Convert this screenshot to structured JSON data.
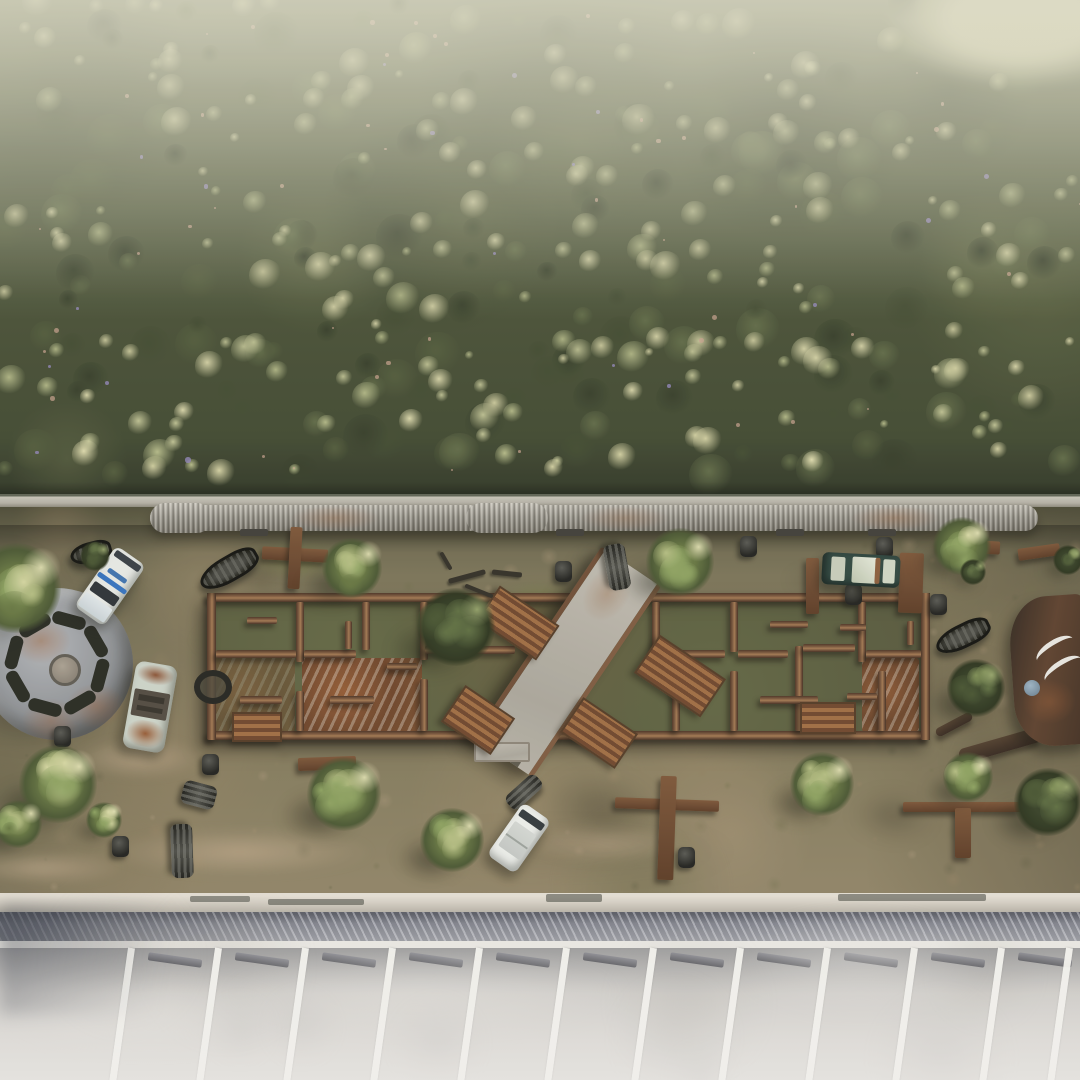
{
  "scene": {
    "type": "aerial-3d-render",
    "description": "Top-down aerial render: dense forest strip, corrugated pipe barrier, dirt paintball arena with ruined roofless building crossed by a diagonal concrete ramp, scrap props (cars, inflatable boats, barrels, wooden crosses, turbine disc, wrecked fuselage), and an angled parking lot at bottom",
    "palette": {
      "forest_pale": [
        "#e0dcab",
        "#d2cf9e",
        "#c2c492",
        "#b5ba85"
      ],
      "forest_dark": [
        "#4e5736",
        "#3e472c",
        "#5d6742",
        "#323a24"
      ],
      "flower_purple": "#8d82b8",
      "speck_pink": "#c9a08a",
      "dirt_tones": [
        "#8d7c5a",
        "#a18a66",
        "#6d6a46",
        "#5c5a3e",
        "#b09a79",
        "#97805f",
        "#7a7050"
      ],
      "haze": "#e3e1c9",
      "rust": "#8a5a36",
      "concrete": "#b5b0a4",
      "moss": "#6a7042"
    },
    "forest": {
      "height": 497,
      "pond": {
        "x": 1020,
        "y": 22,
        "rx": 130,
        "ry": 62,
        "color": "#c9c7a2"
      }
    },
    "pipe": {
      "x": 150,
      "y": 505,
      "w": 888,
      "sleeves": [
        [
          0,
          62
        ],
        [
          316,
          82
        ]
      ],
      "feet": [
        90,
        406,
        626,
        718
      ]
    },
    "building": {
      "x": 207,
      "y": 593,
      "w": 723,
      "h": 147,
      "wall": 9,
      "v_walls": [
        [
          89,
          9,
          60
        ],
        [
          89,
          98,
          40
        ],
        [
          155,
          9,
          48
        ],
        [
          213,
          9,
          58
        ],
        [
          213,
          86,
          52
        ],
        [
          338,
          62,
          76
        ],
        [
          445,
          9,
          53
        ],
        [
          465,
          62,
          76
        ],
        [
          523,
          9,
          50
        ],
        [
          523,
          78,
          60
        ],
        [
          588,
          53,
          85
        ],
        [
          651,
          9,
          60
        ],
        [
          671,
          78,
          60
        ]
      ],
      "h_walls": [
        [
          9,
          57,
          80
        ],
        [
          97,
          57,
          52
        ],
        [
          218,
          53,
          90
        ],
        [
          469,
          57,
          49
        ],
        [
          531,
          57,
          50
        ],
        [
          596,
          51,
          52
        ],
        [
          659,
          57,
          55
        ],
        [
          33,
          103,
          42
        ],
        [
          123,
          103,
          44
        ],
        [
          553,
          103,
          58
        ]
      ],
      "stubs": [
        [
          40,
          24,
          30,
          7
        ],
        [
          138,
          28,
          7,
          28
        ],
        [
          243,
          28,
          7,
          26
        ],
        [
          563,
          28,
          38,
          7
        ],
        [
          633,
          31,
          26,
          7
        ],
        [
          262,
          116,
          36,
          7
        ],
        [
          378,
          31,
          30,
          7
        ],
        [
          180,
          70,
          30,
          7
        ],
        [
          700,
          28,
          7,
          24
        ],
        [
          640,
          100,
          30,
          7
        ]
      ],
      "rust_floors": [
        [
          95,
          65,
          120,
          74,
          0.95
        ],
        [
          655,
          65,
          57,
          74,
          0.9
        ],
        [
          8,
          60,
          80,
          80,
          0.45
        ]
      ]
    },
    "ramp": {
      "cx": 562,
      "cy": 662,
      "w": 62,
      "len": 230,
      "rot": 34,
      "landing": [
        474,
        742,
        52,
        16
      ]
    },
    "stairs": [
      [
        482,
        602,
        68,
        38,
        34
      ],
      [
        448,
        698,
        56,
        40,
        34
      ],
      [
        566,
        712,
        62,
        38,
        34
      ],
      [
        640,
        653,
        76,
        42,
        34
      ],
      [
        232,
        712,
        46,
        26,
        0
      ],
      [
        800,
        702,
        52,
        28,
        0
      ]
    ],
    "turbine": {
      "cx": 57,
      "cy": 664,
      "r": 76,
      "slot_angles": [
        15,
        60,
        105,
        150,
        195,
        240,
        285,
        330
      ]
    },
    "cars": [
      {
        "kind": "police-van",
        "x": 110,
        "y": 586,
        "w": 36,
        "l": 74,
        "rot": 35
      },
      {
        "kind": "rusty-car",
        "x": 150,
        "y": 707,
        "w": 42,
        "l": 88,
        "rot": 10
      },
      {
        "kind": "green-car",
        "x": 861,
        "y": 570,
        "w": 32,
        "l": 78,
        "rot": 93
      },
      {
        "kind": "white-van",
        "x": 519,
        "y": 838,
        "w": 34,
        "l": 64,
        "rot": 35
      }
    ],
    "trees": [
      [
        16,
        588,
        54,
        "L"
      ],
      [
        58,
        784,
        46,
        "L"
      ],
      [
        352,
        568,
        36,
        "L"
      ],
      [
        344,
        794,
        44,
        "L"
      ],
      [
        452,
        840,
        38,
        "L"
      ],
      [
        680,
        562,
        40,
        "L"
      ],
      [
        822,
        784,
        38,
        "L"
      ],
      [
        962,
        546,
        34,
        "L"
      ],
      [
        976,
        688,
        34,
        "D"
      ],
      [
        973,
        572,
        16,
        "D"
      ],
      [
        968,
        777,
        30,
        "L"
      ],
      [
        104,
        820,
        22,
        "L"
      ],
      [
        18,
        824,
        28,
        "L"
      ],
      [
        1048,
        802,
        40,
        "D"
      ],
      [
        456,
        627,
        46,
        "D"
      ],
      [
        95,
        556,
        18,
        "D"
      ],
      [
        1068,
        560,
        18,
        "D"
      ]
    ],
    "boats": [
      [
        226,
        566,
        58,
        20,
        -30
      ],
      [
        960,
        633,
        52,
        18,
        -26
      ],
      [
        88,
        549,
        36,
        15,
        -15
      ]
    ],
    "rolls": [
      [
        617,
        567,
        46,
        22,
        80
      ],
      [
        524,
        792,
        40,
        18,
        -42
      ],
      [
        182,
        851,
        54,
        22,
        88
      ],
      [
        199,
        795,
        34,
        24,
        15
      ]
    ],
    "barrels": [
      [
        748,
        546
      ],
      [
        884,
        547
      ],
      [
        563,
        571
      ],
      [
        938,
        604
      ],
      [
        62,
        736
      ],
      [
        120,
        846
      ],
      [
        686,
        857
      ],
      [
        853,
        594
      ],
      [
        210,
        764
      ]
    ],
    "tires": [
      [
        207,
        681
      ]
    ],
    "sticks": [
      [
        448,
        574,
        38,
        5,
        -15
      ],
      [
        492,
        571,
        30,
        5,
        6
      ],
      [
        464,
        589,
        30,
        4,
        22
      ],
      [
        436,
        559,
        20,
        4,
        60
      ]
    ],
    "planks": [
      [
        806,
        558,
        13,
        56,
        0
      ],
      [
        899,
        553,
        24,
        60,
        2
      ],
      [
        938,
        540,
        62,
        13,
        3
      ],
      [
        1018,
        546,
        42,
        12,
        -8
      ],
      [
        298,
        757,
        58,
        13,
        -2
      ]
    ],
    "logs": [
      [
        958,
        738,
        84,
        15,
        -16
      ],
      [
        934,
        720,
        40,
        9,
        -28
      ]
    ],
    "crosses": [
      {
        "h": [
          262,
          548,
          66,
          13
        ],
        "v": [
          289,
          527,
          12,
          62
        ],
        "rot": 3
      },
      {
        "h": [
          615,
          799,
          104,
          11
        ],
        "v": [
          659,
          776,
          16,
          104
        ],
        "rot": 2
      },
      {
        "h": [
          903,
          802,
          118,
          10
        ],
        "v": [
          955,
          808,
          16,
          50
        ],
        "rot": 0
      }
    ],
    "wreck": {
      "x": 1012,
      "y": 596,
      "w": 78,
      "h": 150,
      "disc": [
        1032,
        688
      ],
      "stripes": [
        [
          1034,
          640
        ],
        [
          1042,
          660
        ]
      ]
    },
    "shadows": [
      [
        600,
        810,
        120,
        70,
        8,
        0.38,
        12
      ],
      [
        893,
        816,
        82,
        46,
        5,
        0.35,
        10
      ],
      [
        256,
        574,
        70,
        32,
        5,
        0.32,
        8
      ],
      [
        968,
        698,
        96,
        74,
        0,
        0.32,
        16
      ],
      [
        18,
        700,
        140,
        54,
        0,
        0.3,
        14
      ],
      [
        826,
        580,
        84,
        26,
        0,
        0.3,
        8
      ],
      [
        0,
        612,
        120,
        120,
        0,
        0.2,
        20
      ],
      [
        560,
        852,
        380,
        40,
        0,
        0.16,
        16
      ],
      [
        996,
        760,
        84,
        60,
        0,
        0.25,
        16
      ],
      [
        120,
        600,
        60,
        40,
        0,
        0.25,
        10
      ]
    ],
    "light_patches": [
      [
        240,
        852,
        270,
        48
      ],
      [
        40,
        868,
        170,
        34
      ],
      [
        606,
        843,
        160,
        40
      ],
      [
        140,
        758,
        130,
        40
      ],
      [
        360,
        700,
        90,
        36
      ],
      [
        820,
        660,
        80,
        30
      ]
    ],
    "green_patches": [
      [
        430,
        688,
        150,
        60
      ],
      [
        700,
        638,
        120,
        56
      ],
      [
        250,
        640,
        120,
        48
      ],
      [
        856,
        700,
        104,
        48
      ],
      [
        540,
        600,
        90,
        40
      ],
      [
        300,
        560,
        120,
        40
      ]
    ],
    "parking": {
      "tabs": [
        [
          190,
          3,
          60,
          6
        ],
        [
          268,
          6,
          96,
          6
        ],
        [
          546,
          1,
          56,
          8
        ],
        [
          838,
          1,
          148,
          7
        ]
      ],
      "lines_x": [
        128,
        215,
        302,
        389,
        476,
        563,
        650,
        737,
        824,
        911,
        998,
        1066
      ],
      "line_w": 7,
      "line_len": 140,
      "lean_deg": 8,
      "stall_top": 55,
      "stop_dx": 20,
      "stop_y": 63,
      "stop_w": 54,
      "stop_h": 8
    }
  }
}
